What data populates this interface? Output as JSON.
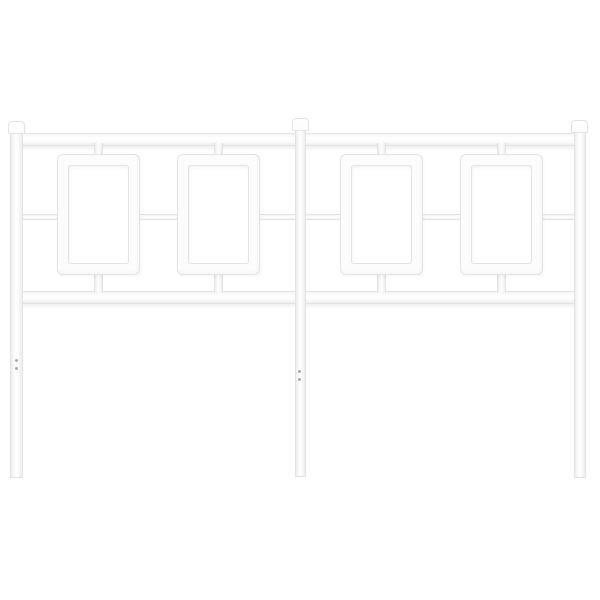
{
  "scene": {
    "subject": "white-metal-headboard-product-photo",
    "text_content": "none"
  },
  "palette": {
    "background": "#ffffff",
    "metal_fill": "#fcfcfc",
    "metal_edge": "#e3e3e3",
    "metal_shade": "#ededed",
    "hole_color": "#ababab"
  },
  "headboard": {
    "parts": [
      {
        "name": "top-rail",
        "kind": "rail-h",
        "x": 14,
        "y": 133,
        "w": 568,
        "h": 13
      },
      {
        "name": "bottom-rail",
        "kind": "rail-h",
        "x": 14,
        "y": 291,
        "w": 568,
        "h": 13
      },
      {
        "name": "panel-1-top-stub",
        "kind": "stub-v",
        "x": 94,
        "y": 143,
        "w": 9,
        "h": 14
      },
      {
        "name": "panel-2-top-stub",
        "kind": "stub-v",
        "x": 214,
        "y": 143,
        "w": 9,
        "h": 14
      },
      {
        "name": "panel-3-top-stub",
        "kind": "stub-v",
        "x": 377,
        "y": 143,
        "w": 9,
        "h": 14
      },
      {
        "name": "panel-4-top-stub",
        "kind": "stub-v",
        "x": 497,
        "y": 143,
        "w": 9,
        "h": 14
      },
      {
        "name": "panel-1-bottom-stub",
        "kind": "stub-v",
        "x": 94,
        "y": 272,
        "w": 9,
        "h": 21
      },
      {
        "name": "panel-2-bottom-stub",
        "kind": "stub-v",
        "x": 214,
        "y": 272,
        "w": 9,
        "h": 21
      },
      {
        "name": "panel-3-bottom-stub",
        "kind": "stub-v",
        "x": 377,
        "y": 272,
        "w": 9,
        "h": 21
      },
      {
        "name": "panel-4-bottom-stub",
        "kind": "stub-v",
        "x": 497,
        "y": 272,
        "w": 9,
        "h": 21
      },
      {
        "name": "mid-bar-left-post-to-panel-1",
        "kind": "connector-h",
        "x": 20,
        "y": 214,
        "w": 40,
        "h": 6
      },
      {
        "name": "mid-bar-panel-1-to-panel-2",
        "kind": "connector-h",
        "x": 137,
        "y": 214,
        "w": 43,
        "h": 6
      },
      {
        "name": "mid-bar-panel-2-to-center-post",
        "kind": "connector-h",
        "x": 257,
        "y": 214,
        "w": 41,
        "h": 6
      },
      {
        "name": "mid-bar-center-post-to-panel-3",
        "kind": "connector-h",
        "x": 303,
        "y": 214,
        "w": 40,
        "h": 6
      },
      {
        "name": "mid-bar-panel-3-to-panel-4",
        "kind": "connector-h",
        "x": 420,
        "y": 214,
        "w": 43,
        "h": 6
      },
      {
        "name": "mid-bar-panel-4-to-right-post",
        "kind": "connector-h",
        "x": 540,
        "y": 214,
        "w": 37,
        "h": 6
      },
      {
        "name": "panel-frame-1",
        "kind": "panel",
        "x": 57,
        "y": 154,
        "w": 83,
        "h": 121
      },
      {
        "name": "panel-frame-2",
        "kind": "panel",
        "x": 177,
        "y": 154,
        "w": 83,
        "h": 121
      },
      {
        "name": "panel-frame-3",
        "kind": "panel",
        "x": 340,
        "y": 154,
        "w": 83,
        "h": 121
      },
      {
        "name": "panel-frame-4",
        "kind": "panel",
        "x": 460,
        "y": 154,
        "w": 83,
        "h": 121
      },
      {
        "name": "left-leg-post",
        "kind": "post-v",
        "x": 10,
        "y": 131,
        "w": 13,
        "h": 347
      },
      {
        "name": "center-leg-post",
        "kind": "post-v",
        "x": 295,
        "y": 129,
        "w": 11,
        "h": 348
      },
      {
        "name": "right-leg-post",
        "kind": "post-v",
        "x": 574,
        "y": 131,
        "w": 12,
        "h": 347
      },
      {
        "name": "left-post-cap",
        "kind": "cap",
        "x": 8,
        "y": 121,
        "w": 17,
        "h": 13
      },
      {
        "name": "center-post-cap",
        "kind": "cap",
        "x": 292,
        "y": 118,
        "w": 17,
        "h": 13
      },
      {
        "name": "right-post-cap",
        "kind": "cap",
        "x": 571,
        "y": 120,
        "w": 17,
        "h": 13
      }
    ],
    "screw_holes": [
      {
        "name": "left-post-screw-hole-upper",
        "x": 15,
        "y": 359,
        "d": 3
      },
      {
        "name": "left-post-screw-hole-lower",
        "x": 15,
        "y": 367,
        "d": 3
      },
      {
        "name": "center-post-screw-hole-upper",
        "x": 298,
        "y": 370,
        "d": 3
      },
      {
        "name": "center-post-screw-hole-lower",
        "x": 298,
        "y": 378,
        "d": 3
      }
    ]
  }
}
